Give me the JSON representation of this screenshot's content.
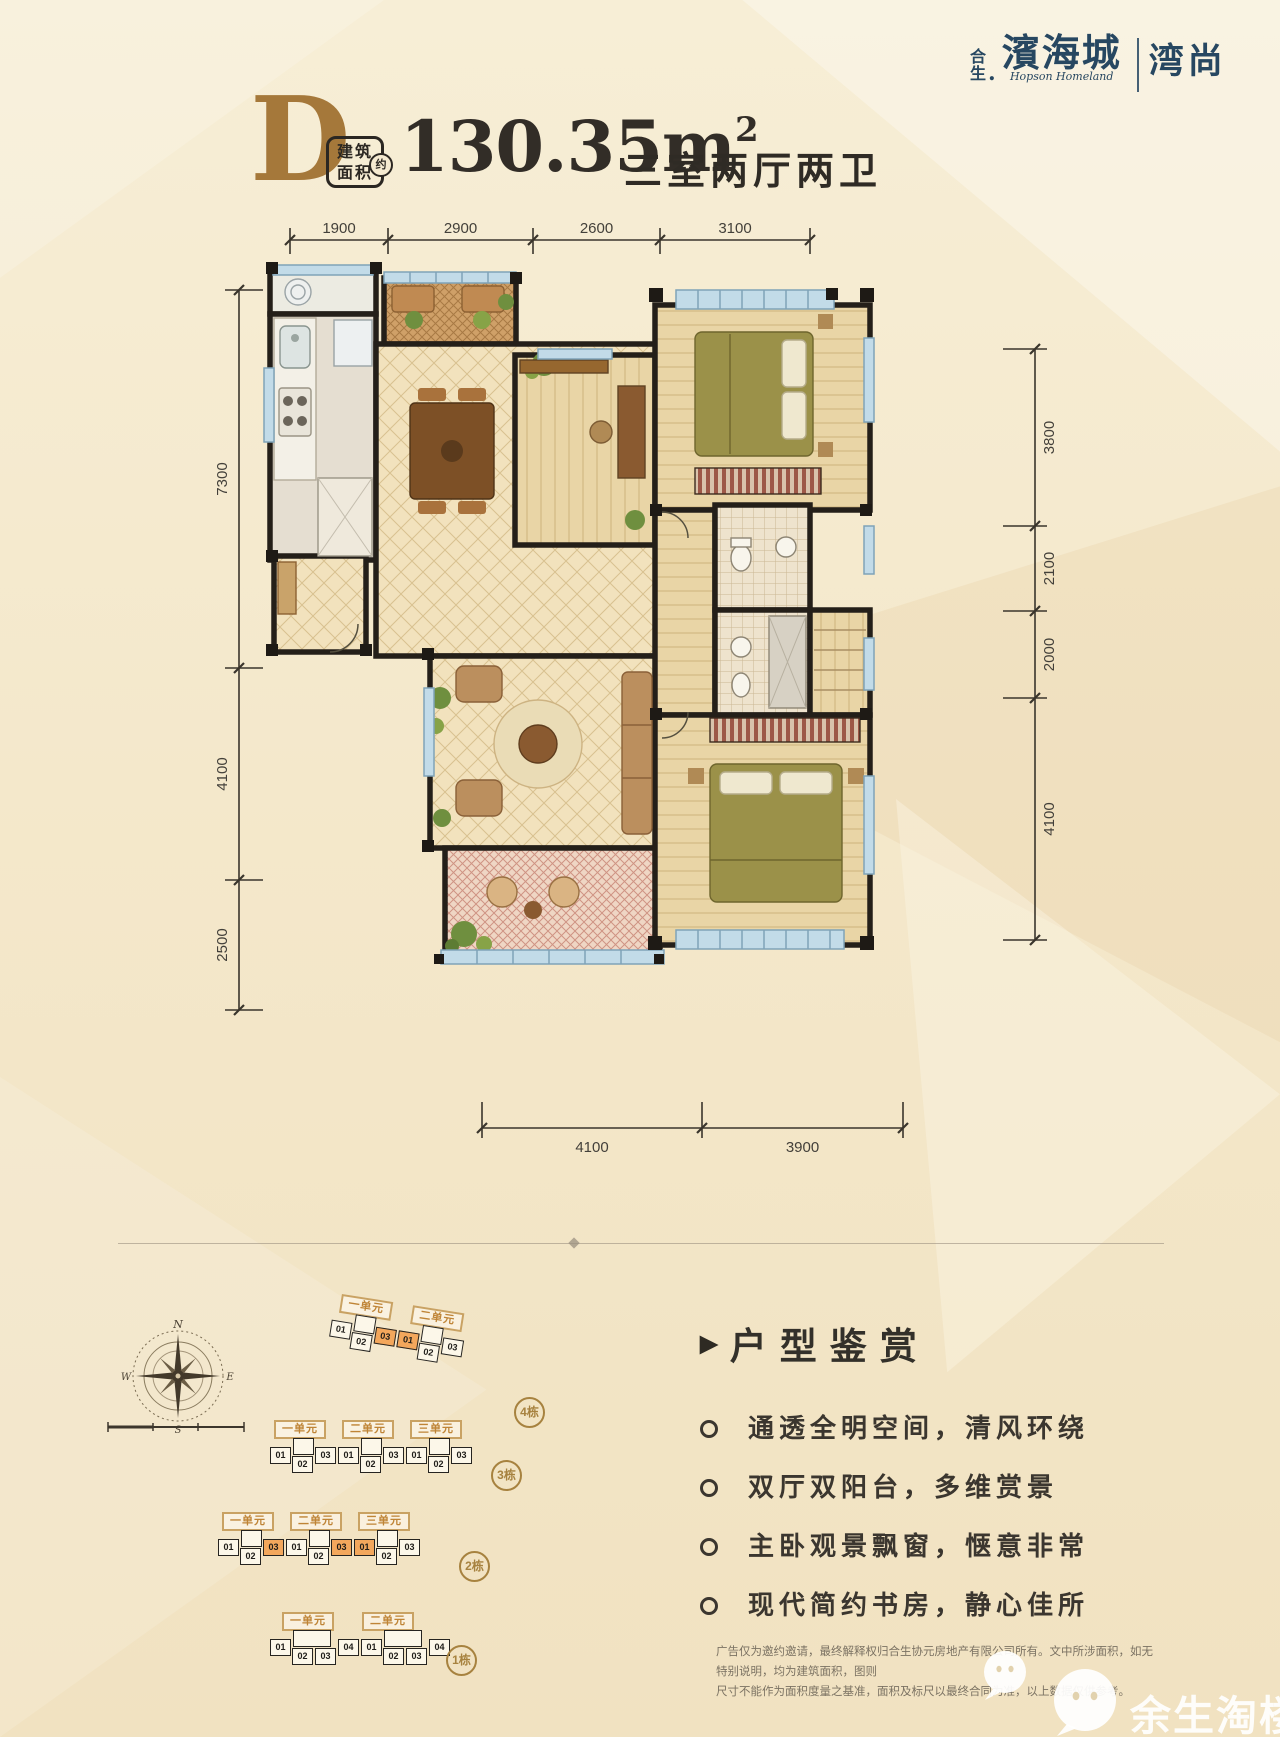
{
  "logo": {
    "prefix_top": "合",
    "prefix_bottom": "生",
    "dot": ".",
    "brand": "濱海城",
    "brand_en": "Hopson Homeland",
    "series": "湾尚"
  },
  "title": {
    "type_letter": "D",
    "badge_line1": "建筑",
    "badge_line2": "面积",
    "badge_approx": "约",
    "area_value": "130.35m",
    "area_exponent": "2",
    "rooms_text": "三室两厅两卫"
  },
  "dimensions": {
    "top": [
      "1900",
      "2900",
      "2600",
      "3100"
    ],
    "left": [
      "7300",
      "4100",
      "2500"
    ],
    "right": [
      "3800",
      "2100",
      "2000",
      "4100"
    ],
    "bottom": [
      "4100",
      "3900"
    ]
  },
  "compass": {
    "north": "N",
    "east": "E",
    "south": "S",
    "west": "W"
  },
  "site_plan": {
    "buildings": [
      {
        "name": "4栋",
        "units": [
          "一单元",
          "二单元"
        ],
        "cells": [
          {
            "t": "01"
          },
          {
            "t": "",
            "raised": true
          },
          {
            "t": "02",
            "low": true,
            "tuck": true
          },
          {
            "t": "03",
            "hl": true
          },
          {
            "t": "01",
            "hl": true
          },
          {
            "t": "",
            "raised": true
          },
          {
            "t": "02",
            "low": true,
            "tuck": true
          },
          {
            "t": "03"
          }
        ]
      },
      {
        "name": "3栋",
        "units": [
          "一单元",
          "二单元",
          "三单元"
        ],
        "cells": [
          {
            "t": "01"
          },
          {
            "t": "",
            "raised": true
          },
          {
            "t": "02",
            "low": true,
            "tuck": true
          },
          {
            "t": "03"
          },
          {
            "t": "01"
          },
          {
            "t": "",
            "raised": true
          },
          {
            "t": "02",
            "low": true,
            "tuck": true
          },
          {
            "t": "03"
          },
          {
            "t": "01"
          },
          {
            "t": "",
            "raised": true
          },
          {
            "t": "02",
            "low": true,
            "tuck": true
          },
          {
            "t": "03"
          }
        ]
      },
      {
        "name": "2栋",
        "units": [
          "一单元",
          "二单元",
          "三单元"
        ],
        "cells": [
          {
            "t": "01"
          },
          {
            "t": "",
            "raised": true
          },
          {
            "t": "02",
            "low": true,
            "tuck": true
          },
          {
            "t": "03",
            "hl": true
          },
          {
            "t": "01"
          },
          {
            "t": "",
            "raised": true
          },
          {
            "t": "02",
            "low": true,
            "tuck": true
          },
          {
            "t": "03",
            "hl": true
          },
          {
            "t": "01",
            "hl": true
          },
          {
            "t": "",
            "raised": true
          },
          {
            "t": "02",
            "low": true,
            "tuck": true
          },
          {
            "t": "03"
          }
        ]
      },
      {
        "name": "1栋",
        "units": [
          "一单元",
          "二单元"
        ],
        "cells": [
          {
            "t": "01"
          },
          {
            "t": "",
            "raised": true,
            "wide": true
          },
          {
            "t": "02",
            "low": true,
            "tuck": true
          },
          {
            "t": "03",
            "low": true
          },
          {
            "t": "04"
          },
          {
            "t": "01"
          },
          {
            "t": "",
            "raised": true,
            "wide": true
          },
          {
            "t": "02",
            "low": true,
            "tuck": true
          },
          {
            "t": "03",
            "low": true
          },
          {
            "t": "04"
          }
        ]
      }
    ]
  },
  "features": {
    "heading": "户型鉴赏",
    "marker": "▶",
    "items": [
      "通透全明空间，清风环绕",
      "双厅双阳台，多维赏景",
      "主卧观景飘窗，惬意非常",
      "现代简约书房，静心佳所"
    ]
  },
  "disclaimer": {
    "line1": "广告仅为邀约邀请，最终解释权归合生协元房地产有限公司所有。文中所涉面积，如无特别说明，均为建筑面积，图则",
    "line2": "尺寸不能作为面积度量之基准，面积及标尺以最终合同为准，以上数据仅供参考。"
  },
  "watermark": {
    "text": "余生淘楼"
  },
  "colors": {
    "navy": "#274761",
    "gold": "#a5783a",
    "ink": "#322d27",
    "highlight_orange": "#f3a75c",
    "label_brown": "#bf8436",
    "background": "#f4e8cb"
  }
}
